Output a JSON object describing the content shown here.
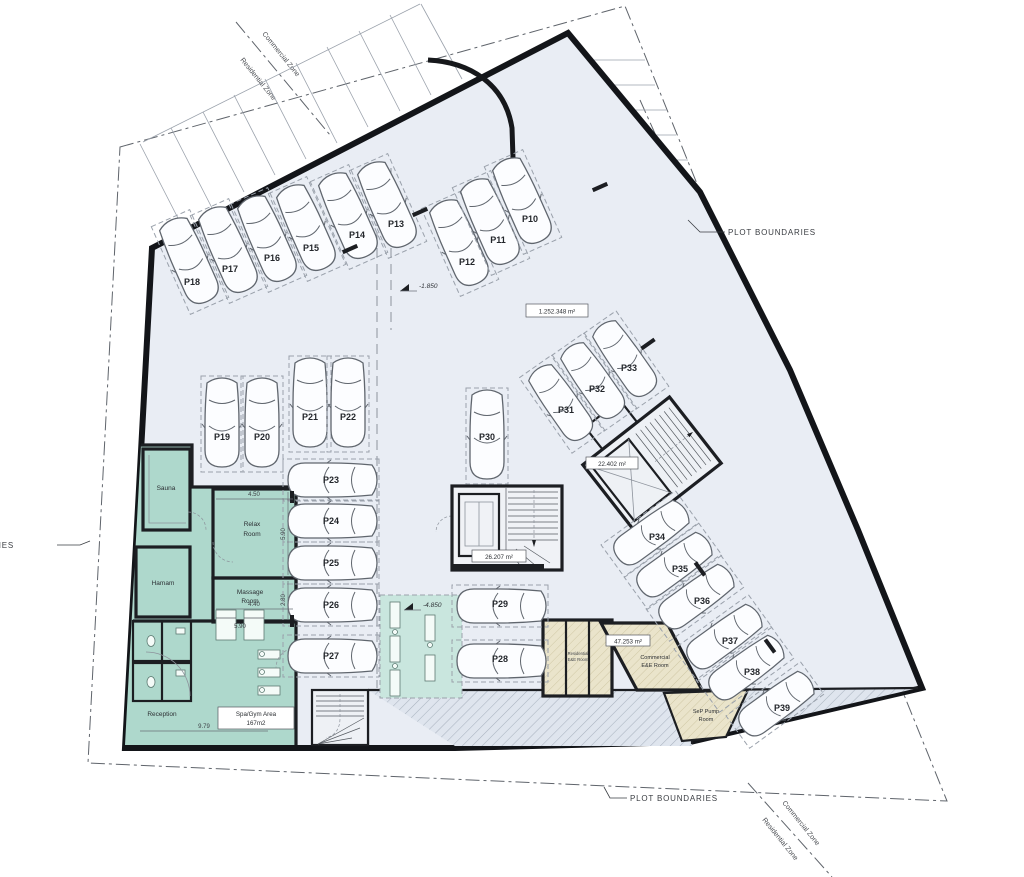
{
  "plan": {
    "parking": {
      "p10": "P10",
      "p11": "P11",
      "p12": "P12",
      "p13": "P13",
      "p14": "P14",
      "p15": "P15",
      "p16": "P16",
      "p17": "P17",
      "p18": "P18",
      "p19": "P19",
      "p20": "P20",
      "p21": "P21",
      "p22": "P22",
      "p23": "P23",
      "p24": "P24",
      "p25": "P25",
      "p26": "P26",
      "p27": "P27",
      "p28": "P28",
      "p29": "P29",
      "p30": "P30",
      "p31": "P31",
      "p32": "P32",
      "p33": "P33",
      "p34": "P34",
      "p35": "P35",
      "p36": "P36",
      "p37": "P37",
      "p38": "P38",
      "p39": "P39"
    },
    "rooms": {
      "sauna": "Sauna",
      "hamam": "Hamam",
      "relax_line1": "Relax",
      "relax_line2": "Room",
      "massage_line1": "Massage",
      "massage_line2": "Room",
      "reception": "Reception",
      "spa_gym_line1": "Spa/Gym Area",
      "spa_gym_line2": "167m2",
      "commercial_line1": "Commercial",
      "commercial_line2": "E&E Room",
      "residential_line1": "Residential",
      "residential_line2": "E&E Room",
      "pump_line1": "SeP Pump",
      "pump_line2": "Room"
    },
    "areas": {
      "plot_total": "1.252.348 m²",
      "core_upper": "22.402 m²",
      "core_central": "26.207 m²",
      "commercial_room": "47.253 m²"
    },
    "levels": {
      "upper": "-1.850",
      "lower": "-4.850"
    },
    "boundaries": {
      "plot": "PLOT BOUNDARIES",
      "zone_line1": "Commercial Zone",
      "zone_line2": "Residential Zone"
    },
    "dimensions": {
      "relax_width": "4.50",
      "relax_height": "5.90",
      "massage_height": "2.80",
      "massage_width": "4.40",
      "gym_width": "5.90",
      "reception_width": "9.79"
    }
  }
}
